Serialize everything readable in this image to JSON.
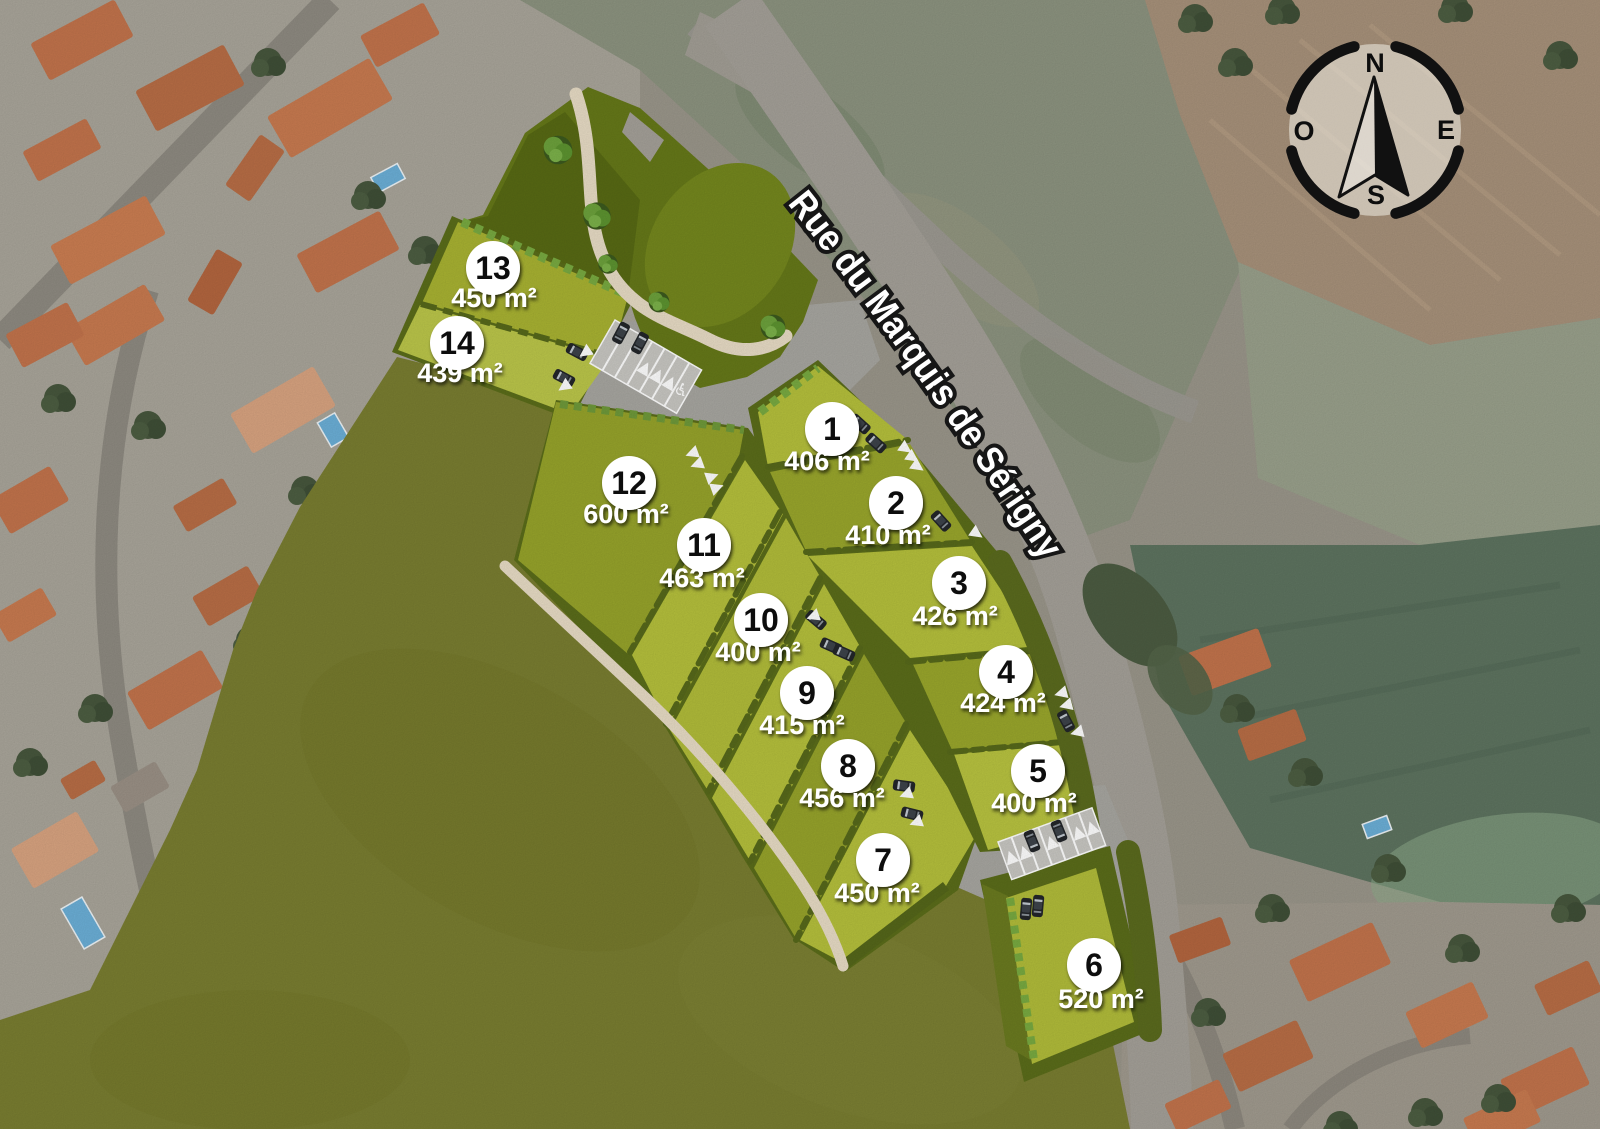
{
  "street": {
    "label": "Rue du Marquis de Sérigny"
  },
  "compass": {
    "north": "N",
    "east": "E",
    "south": "S",
    "west": "O"
  },
  "icons": {
    "handicap": "♿"
  },
  "area_unit": "m²",
  "plots": [
    {
      "number": "1",
      "area": "406 m²"
    },
    {
      "number": "2",
      "area": "410 m²"
    },
    {
      "number": "3",
      "area": "426 m²"
    },
    {
      "number": "4",
      "area": "424 m²"
    },
    {
      "number": "5",
      "area": "400 m²"
    },
    {
      "number": "6",
      "area": "520 m²"
    },
    {
      "number": "7",
      "area": "450 m²"
    },
    {
      "number": "8",
      "area": "456 m²"
    },
    {
      "number": "9",
      "area": "415 m²"
    },
    {
      "number": "10",
      "area": "400 m²"
    },
    {
      "number": "11",
      "area": "463 m²"
    },
    {
      "number": "12",
      "area": "600 m²"
    },
    {
      "number": "13",
      "area": "450 m²"
    },
    {
      "number": "14",
      "area": "439 m²"
    }
  ],
  "colors": {
    "plot_light": "#b6c13c",
    "plot_dark": "#97a42b",
    "hedge": "#5b6d1a",
    "field_overlay": "#7a7e31",
    "road": "#a8a7a1",
    "path": "#e9ddc6",
    "label_circle": "#ffffff"
  }
}
